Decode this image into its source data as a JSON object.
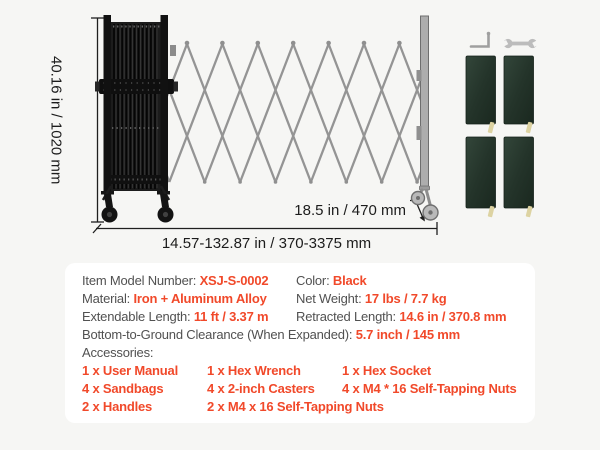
{
  "page": {
    "background": "#f6f6f4"
  },
  "figure": {
    "height_dimension": "40.16 in / 1020 mm",
    "width_dimension": "14.57-132.87 in / 370-3375 mm",
    "depth_dimension": "18.5 in / 470 mm"
  },
  "icons": {
    "hex_wrench": "hex-wrench-icon",
    "wrench": "wrench-icon",
    "sandbags": "sandbag-image",
    "gate": "expandable-barrier-gate-image"
  },
  "colors": {
    "accent": "#f1492a",
    "label_text": "#515151",
    "dimension_text": "#1c1c1c",
    "card_bg": "#ffffff",
    "lattice_gray": "#949494",
    "gate_black": "#1c1c1c",
    "sandbag_green": "#24342a"
  },
  "specs": {
    "model_label": "Item Model Number: ",
    "model_value": "XSJ-S-0002",
    "color_label": "Color: ",
    "color_value": "Black",
    "material_label": "Material: ",
    "material_value": "Iron + Aluminum Alloy",
    "net_weight_label": "Net Weight: ",
    "net_weight_value": "17 lbs / 7.7 kg",
    "extendable_label": "Extendable Length: ",
    "extendable_value": "11 ft / 3.37 m",
    "retracted_label": "Retracted Length: ",
    "retracted_value": "14.6 in / 370.8 mm",
    "clearance_label": "Bottom-to-Ground Clearance (When Expanded): ",
    "clearance_value": "5.7 inch / 145 mm",
    "accessories_label": "Accessories:",
    "accessories": [
      "1 x User Manual",
      "1 x Hex Wrench",
      "1 x Hex Socket",
      "4 x Sandbags",
      "4 x 2-inch Casters",
      "4 x M4 * 16 Self-Tapping Nuts",
      "2 x Handles",
      "2 x M4 x 16 Self-Tapping Nuts"
    ]
  }
}
